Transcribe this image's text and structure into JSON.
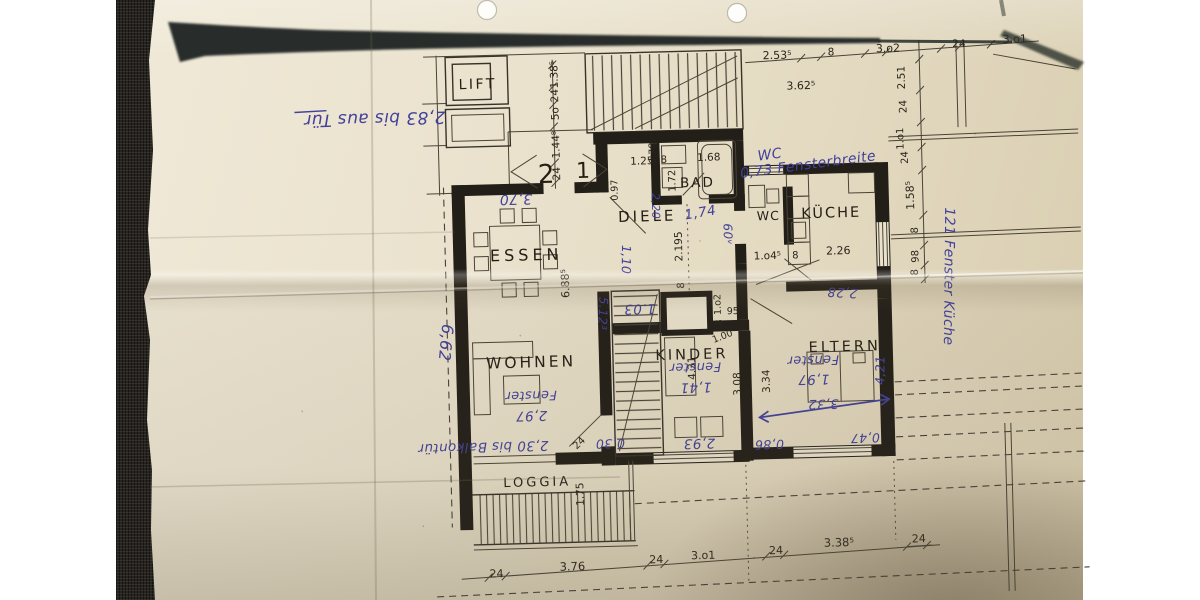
{
  "photo": {
    "background": "#ffffff",
    "fabric_color": "#27241f",
    "paper_color": "#eae2cd",
    "print_ink": "#2a241b",
    "pen_ink": "#42419b"
  },
  "plan": {
    "rooms": [
      {
        "id": "lift",
        "label": "LIFT"
      },
      {
        "id": "essen",
        "label": "ESSEN"
      },
      {
        "id": "diele",
        "label": "DIELE"
      },
      {
        "id": "bad",
        "label": "BAD"
      },
      {
        "id": "wc",
        "label": "WC"
      },
      {
        "id": "kueche",
        "label": "KÜCHE"
      },
      {
        "id": "wohnen",
        "label": "WOHNEN"
      },
      {
        "id": "kinder",
        "label": "KINDER"
      },
      {
        "id": "eltern",
        "label": "ELTERN"
      },
      {
        "id": "loggia",
        "label": "LOGGIA"
      }
    ],
    "flat_numbers": [
      "2",
      "1"
    ],
    "printed_dims": [
      {
        "t": "1.38⁵"
      },
      {
        "t": "24"
      },
      {
        "t": "5o"
      },
      {
        "t": "1.44⁸"
      },
      {
        "t": "24"
      },
      {
        "t": "0.78"
      },
      {
        "t": "1.25"
      },
      {
        "t": "8"
      },
      {
        "t": "1.68"
      },
      {
        "t": "8 1.72"
      },
      {
        "t": "2.195"
      },
      {
        "t": "8"
      },
      {
        "t": "0.97"
      },
      {
        "t": "6.88⁵"
      },
      {
        "t": "1.o4⁵"
      },
      {
        "t": "8"
      },
      {
        "t": "2.26"
      },
      {
        "t": "2.53⁵"
      },
      {
        "t": "8"
      },
      {
        "t": "3.o2"
      },
      {
        "t": "24"
      },
      {
        "t": "3.o1"
      },
      {
        "t": "3.62⁵"
      },
      {
        "t": "2.51"
      },
      {
        "t": "24"
      },
      {
        "t": "1.o1"
      },
      {
        "t": "24"
      },
      {
        "t": "1.58⁵"
      },
      {
        "t": "8"
      },
      {
        "t": "98"
      },
      {
        "t": "8"
      },
      {
        "t": "24"
      },
      {
        "t": "3.76"
      },
      {
        "t": "24"
      },
      {
        "t": "3.o1"
      },
      {
        "t": "24"
      },
      {
        "t": "3.38⁵"
      },
      {
        "t": "24"
      },
      {
        "t": "1.75"
      },
      {
        "t": "4.31"
      },
      {
        "t": "3.08"
      },
      {
        "t": "3.34"
      },
      {
        "t": "1.o2"
      },
      {
        "t": "8"
      },
      {
        "t": "95"
      },
      {
        "t": "1.00"
      },
      {
        "t": "24"
      }
    ],
    "handwritten_notes": [
      {
        "t": "2,83 bis aus Tür"
      },
      {
        "t": "3,70"
      },
      {
        "t": "WC"
      },
      {
        "t": "0,73 Fensterbreite"
      },
      {
        "t": "1,74"
      },
      {
        "t": "2,20"
      },
      {
        "t": "60ᵛ"
      },
      {
        "t": "1.03"
      },
      {
        "t": "5.12³"
      },
      {
        "t": "Fenster"
      },
      {
        "t": "1,41"
      },
      {
        "t": "Fenster"
      },
      {
        "t": "1,97"
      },
      {
        "t": "Fenster"
      },
      {
        "t": "2,97"
      },
      {
        "t": "2,93"
      },
      {
        "t": "0,30"
      },
      {
        "t": "0,86"
      },
      {
        "t": "0,47"
      },
      {
        "t": "3,32"
      },
      {
        "t": "4,21"
      },
      {
        "t": "2,28"
      },
      {
        "t": "6,62"
      },
      {
        "t": "2,30 bis Balkontür"
      },
      {
        "t": "121 Fenster Küche"
      },
      {
        "t": "1,10"
      }
    ]
  }
}
